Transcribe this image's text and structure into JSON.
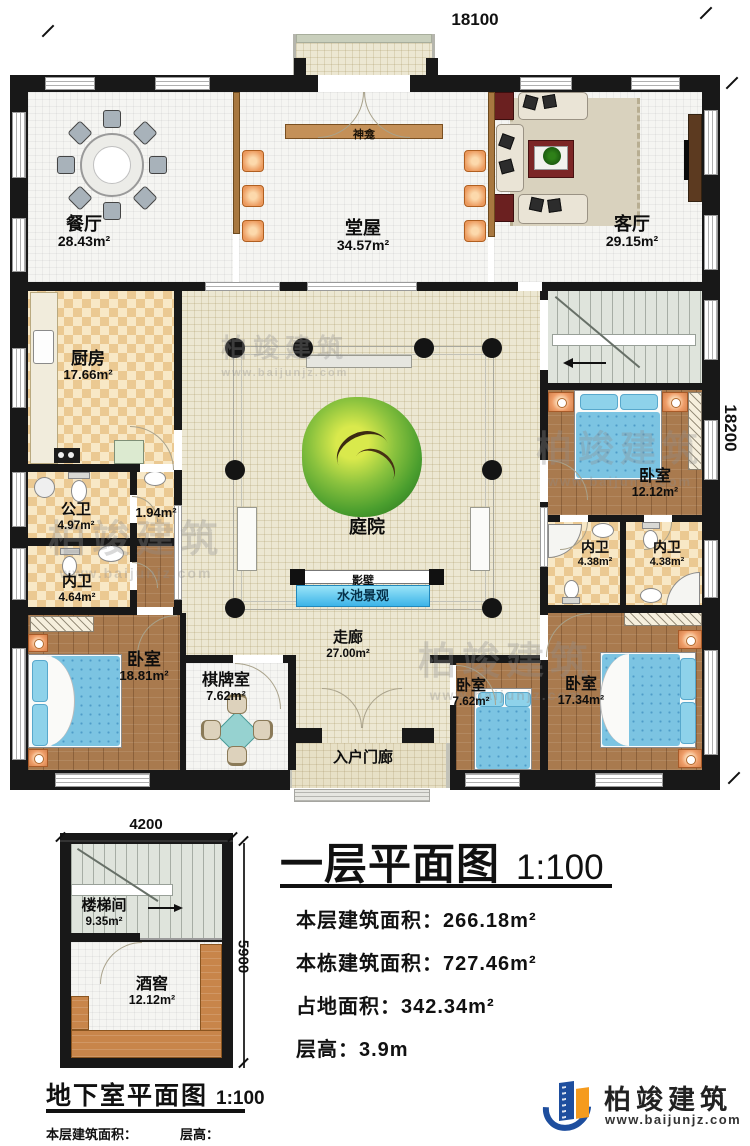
{
  "plan": {
    "dim_top": "18100",
    "dim_right": "18200",
    "rooms": {
      "dining": {
        "name": "餐厅",
        "area": "28.43m²"
      },
      "hall": {
        "name": "堂屋",
        "area": "34.57m²"
      },
      "living": {
        "name": "客厅",
        "area": "29.15m²"
      },
      "shrine": {
        "name": "神龛"
      },
      "kitchen": {
        "name": "厨房",
        "area": "17.66m²"
      },
      "public_bath": {
        "name": "公卫",
        "area": "4.97m²"
      },
      "closet": {
        "area": "1.94m²"
      },
      "inner_bath_left": {
        "name": "内卫",
        "area": "4.64m²"
      },
      "bedroom_left": {
        "name": "卧室",
        "area": "18.81m²"
      },
      "chess": {
        "name": "棋牌室",
        "area": "7.62m²"
      },
      "corridor": {
        "name": "走廊",
        "area": "27.00m²"
      },
      "entry_porch": {
        "name": "入户门廊"
      },
      "bedroom_small": {
        "name": "卧室",
        "area": "7.62m²"
      },
      "bedroom_right": {
        "name": "卧室",
        "area": "17.34m²"
      },
      "bedroom_mid": {
        "name": "卧室",
        "area": "12.12m²"
      },
      "inner_bath_r1": {
        "name": "内卫",
        "area": "4.38m²"
      },
      "inner_bath_r2": {
        "name": "内卫",
        "area": "4.38m²"
      },
      "courtyard": {
        "name": "庭院"
      },
      "screen_wall": {
        "name": "影壁"
      },
      "pool": {
        "name": "水池景观"
      }
    }
  },
  "basement": {
    "dim_top": "4200",
    "dim_right": "5900",
    "rooms": {
      "stairwell": {
        "name": "楼梯间",
        "area": "9.35m²"
      },
      "cellar": {
        "name": "酒窖",
        "area": "12.12m²"
      }
    },
    "title": "地下室平面图",
    "scale": "1:100",
    "stats": {
      "area_label": "本层建筑面积：",
      "area_value": "27.26m²",
      "height_label": "层高：",
      "height_value": "2.8m"
    }
  },
  "title_block": {
    "title": "一层平面图",
    "scale": "1:100",
    "stats": [
      {
        "label": "本层建筑面积：",
        "value": "266.18m²"
      },
      {
        "label": "本栋建筑面积：",
        "value": "727.46m²"
      },
      {
        "label": "占地面积：",
        "value": "342.34m²"
      },
      {
        "label": "层高：",
        "value": "3.9m"
      }
    ]
  },
  "logo": {
    "name": "柏竣建筑",
    "url": "www.baijunjz.com"
  },
  "watermark": {
    "name": "柏竣建筑",
    "url": "www.baijunjz.com"
  },
  "colors": {
    "wall": "#181818",
    "accent_blue": "#1e4e9e",
    "accent_orange": "#f59b1e",
    "pool": "#5ec6ee"
  }
}
